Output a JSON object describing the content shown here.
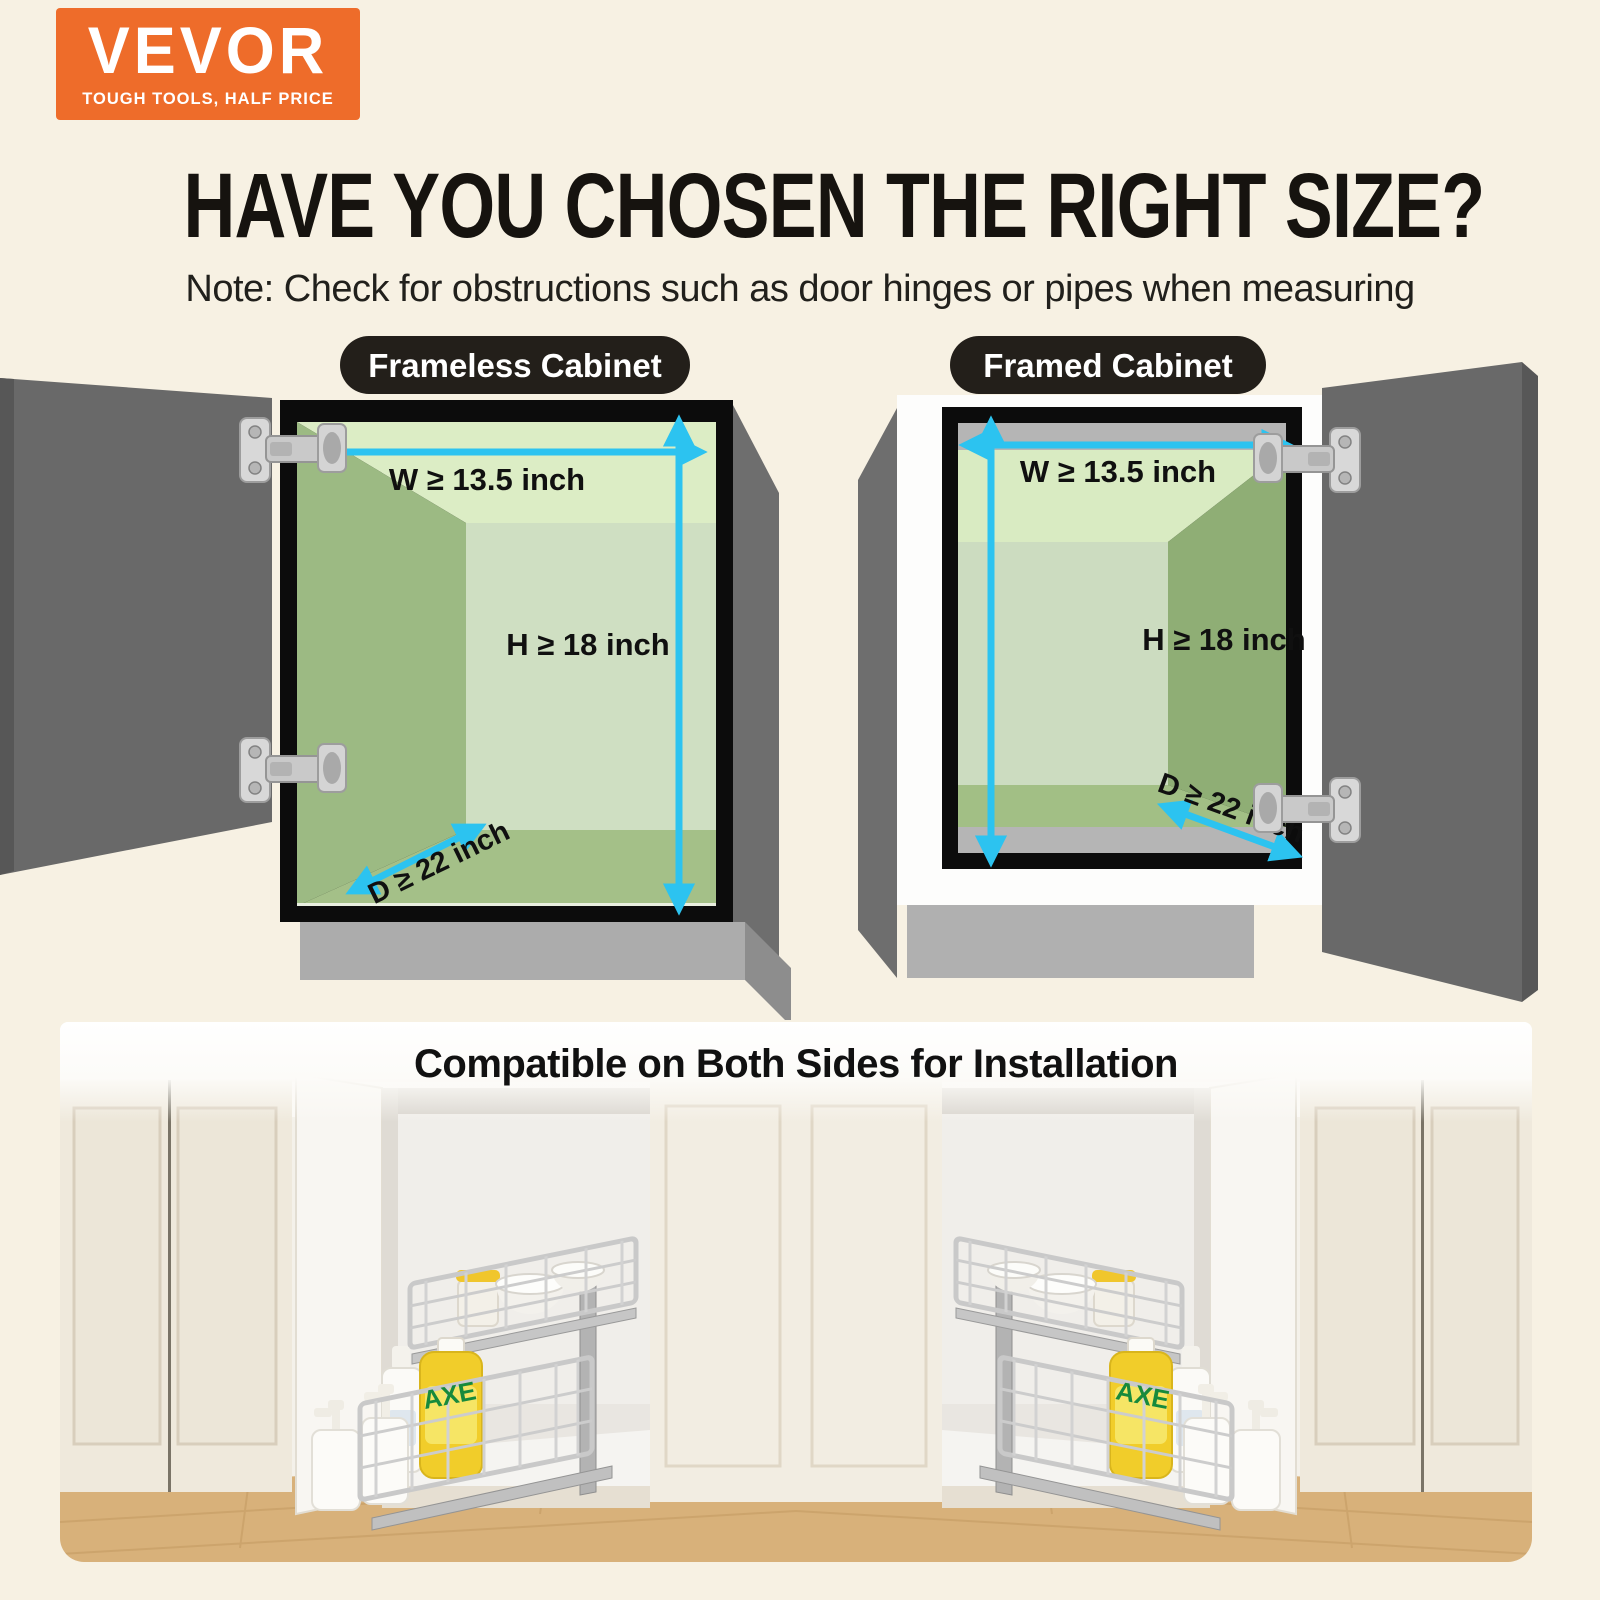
{
  "brand": {
    "name": "VEVOR",
    "tagline": "TOUGH TOOLS, HALF PRICE"
  },
  "header": {
    "title": "HAVE YOU CHOSEN THE RIGHT SIZE?",
    "note": "Note: Check for obstructions such as door hinges or pipes when measuring"
  },
  "diagrams": {
    "frameless": {
      "label": "Frameless Cabinet",
      "width": "W ≥ 13.5 inch",
      "height": "H ≥ 18 inch",
      "depth": "D ≥ 22 inch"
    },
    "framed": {
      "label": "Framed Cabinet",
      "width": "W ≥ 13.5 inch",
      "height": "H ≥ 18 inch",
      "depth": "D ≥ 22 inch"
    }
  },
  "footer": {
    "heading": "Compatible on Both Sides for Installation",
    "bottle_label": "AXE"
  },
  "colors": {
    "background": "#f7f1e3",
    "brand_orange": "#ee6c2a",
    "pill_dark": "#231f1a",
    "arrow_cyan": "#2cc3f0",
    "cabinet_green_ceiling": "#dcedc5",
    "cabinet_green_wall": "#9cba83",
    "cabinet_green_back": "#cfdfc2",
    "cabinet_green_floor": "#a4c088",
    "door_gray": "#696969"
  }
}
